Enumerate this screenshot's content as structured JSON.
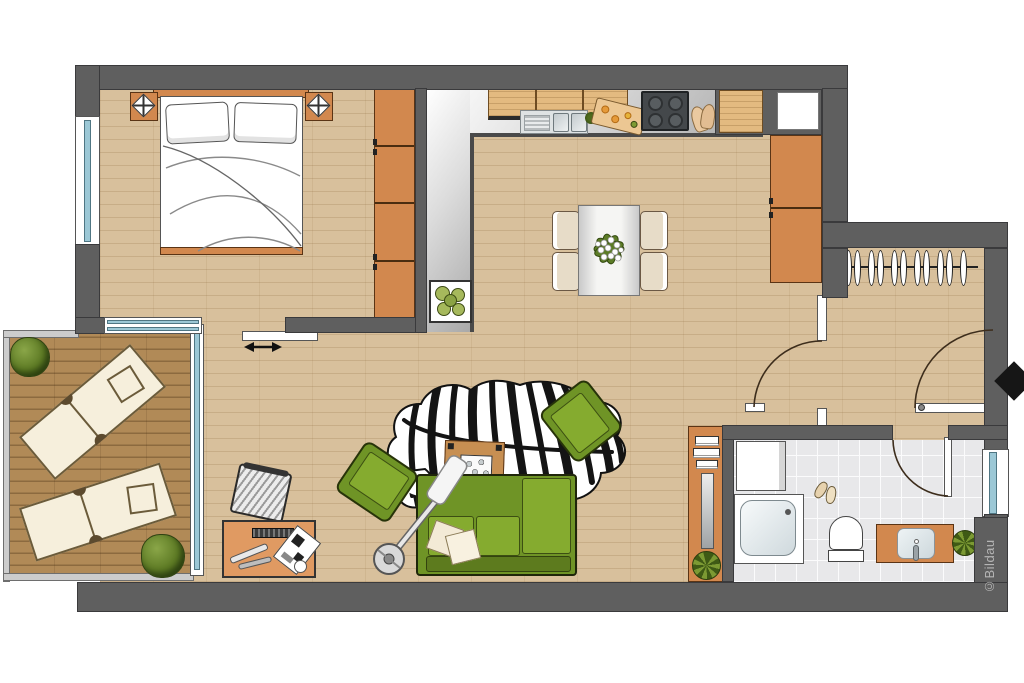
{
  "document": {
    "type": "apartment-floor-plan",
    "watermark": "©Bildau"
  },
  "palette": {
    "wall": "#5f5f5f",
    "wood_floor": "#d8c09c",
    "balcony_deck": "#b18a57",
    "kitchen_floor_gradient": [
      "#ffffff",
      "#a9a9a9"
    ],
    "bathroom_floor": "#e8e8ea",
    "orange_furniture": "#d2884e",
    "light_wood_furniture": "#e3ba80",
    "sofa_green": "#85ab2f",
    "plant_green": "#5d7a24",
    "window_glass": "#9cc8d6",
    "entrance_marker": "#161616",
    "rug": "zebra-black-white"
  },
  "rooms": [
    {
      "name": "bedroom",
      "furniture": [
        "double-bed",
        "headboard",
        "pillows",
        "nightstand-left",
        "nightstand-right",
        "table-lamps",
        "wardrobe",
        "sliding-door",
        "window-left",
        "balcony-glass-door"
      ]
    },
    {
      "name": "kitchen",
      "furniture": [
        "upper-cabinets",
        "double-sink",
        "vegetables",
        "cutting-board",
        "cooktop",
        "oven-mitts",
        "counter-cabinet",
        "fridge-niche",
        "plant-box"
      ]
    },
    {
      "name": "dining-area",
      "furniture": [
        "dining-table",
        "chair",
        "chair",
        "chair",
        "chair",
        "flower-centerpiece",
        "tall-cabinet"
      ]
    },
    {
      "name": "living-area",
      "furniture": [
        "corner-sofa",
        "sofa-pillows",
        "armchair",
        "armchair",
        "coffee-table",
        "stone-tray",
        "zebra-rug",
        "arc-floor-lamp",
        "desk",
        "office-chair",
        "keyboard",
        "laptop",
        "desk-lamp"
      ]
    },
    {
      "name": "hallway",
      "furniture": [
        "coat-rack",
        "interior-door",
        "entrance-door",
        "entrance-arrow"
      ]
    },
    {
      "name": "bathroom",
      "furniture": [
        "washing-machine",
        "shower",
        "slippers",
        "toilet",
        "vanity-sink",
        "towel-shelf",
        "wall-mirror",
        "plant",
        "plant",
        "window"
      ]
    },
    {
      "name": "balcony",
      "furniture": [
        "sun-lounger",
        "sun-lounger",
        "bush-plant",
        "bush-plant",
        "glass-front"
      ]
    }
  ]
}
